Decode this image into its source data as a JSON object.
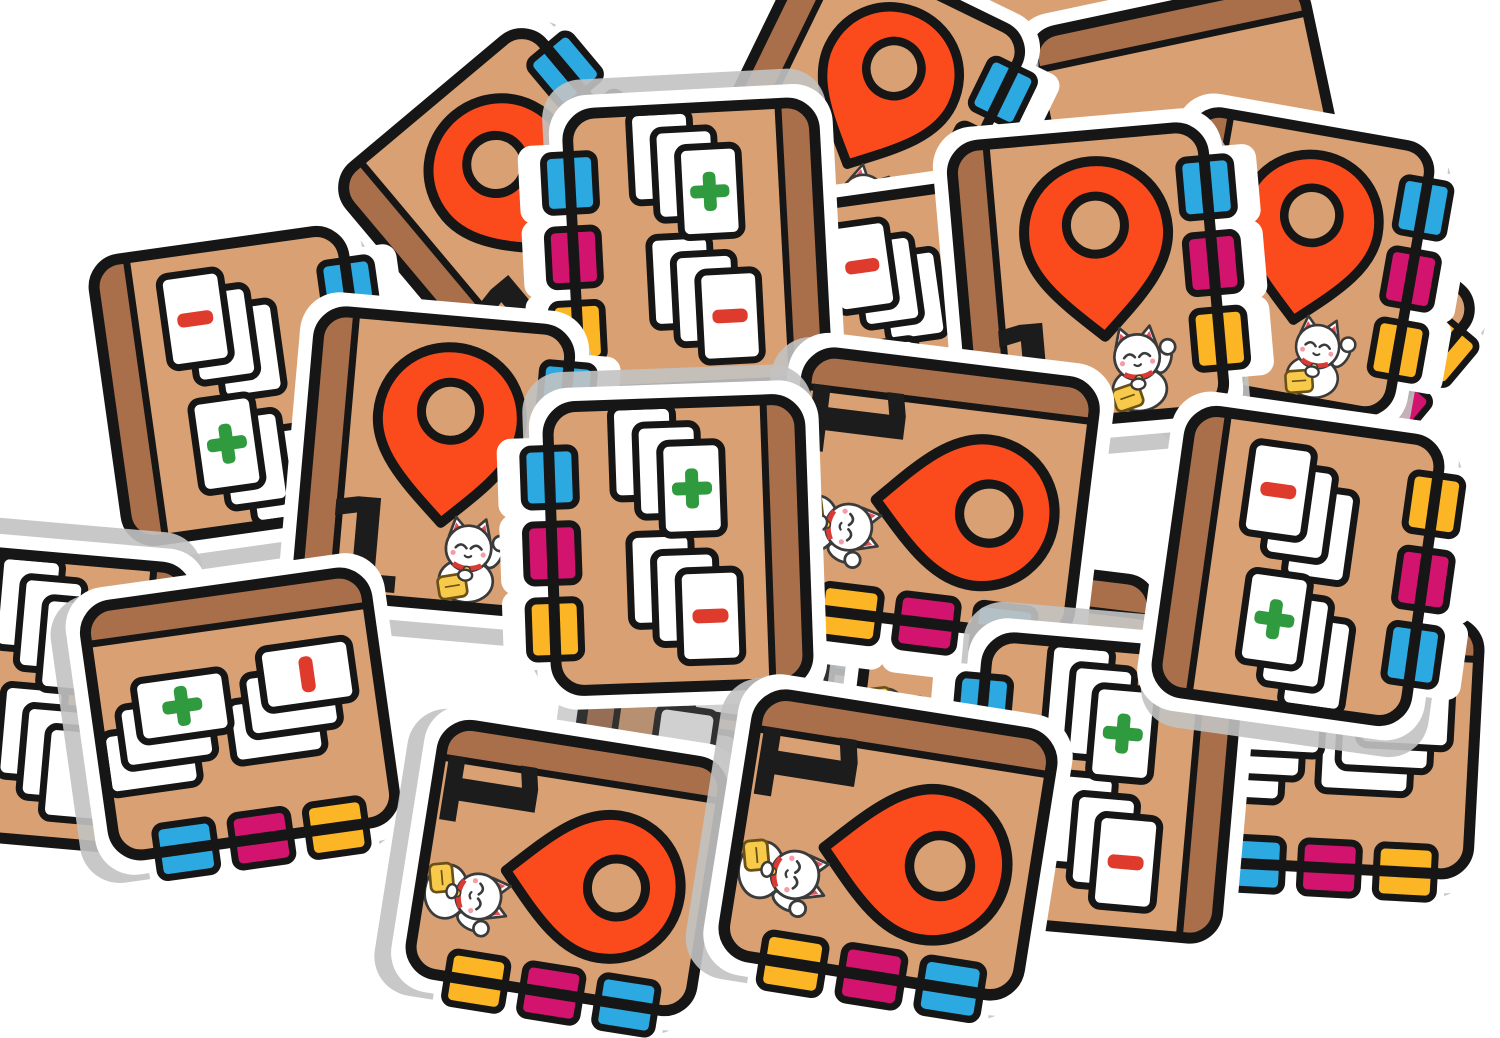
{
  "scene": {
    "label": "pile of cardboard notebook game tiles",
    "width": 1500,
    "height": 1038,
    "background": "#ffffff"
  },
  "palette": {
    "sticker": "#ffffff",
    "shadow": "#c2c2c2",
    "outline": "#161616",
    "cover": "#d9a173",
    "spine": "#a86f4a",
    "pin": "#fb4b1c",
    "pin_hole": "#d9a173",
    "card": "#ffffff",
    "number": "#1c1c1c",
    "plus": "#2f9b3e",
    "minus": "#df3b2d",
    "tabs": {
      "blue": "#2ba9e0",
      "magenta": "#d2146e",
      "yellow": "#fcb525"
    },
    "cat": {
      "body": "#ffffff",
      "outline": "#3b3b3b",
      "inner_ear": "#e8505b",
      "cheek": "#f59da6",
      "collar": "#d93a34",
      "coin": "#f8ca4b",
      "coin_outline": "#6b5116"
    }
  },
  "tile_types": {
    "pin": {
      "label": "location marker notebook tile",
      "number": "1"
    },
    "cards": {
      "label": "card stacks notebook tile",
      "plus_glyph": "+",
      "minus_glyph": "−"
    },
    "cover": {
      "label": "plain notebook tile"
    }
  },
  "tiles": [
    {
      "id": "cover-back-top-right",
      "type": "cover",
      "cx": 985,
      "cy": 92,
      "rot": 18,
      "scale": 0.95,
      "tabs": [
        "blue",
        "magenta",
        "yellow"
      ]
    },
    {
      "id": "cover-side-top-right",
      "type": "cover",
      "cx": 1190,
      "cy": 128,
      "rot": 78,
      "scale": 0.98,
      "tabs": [
        "blue",
        "magenta",
        "yellow"
      ]
    },
    {
      "id": "pin-tile-top-mid-right",
      "type": "pin",
      "cx": 862,
      "cy": 108,
      "rot": 26,
      "scale": 0.95,
      "tabs": [
        "blue",
        "magenta",
        "yellow"
      ]
    },
    {
      "id": "cover-back-far-right",
      "type": "cover",
      "cx": 1302,
      "cy": 332,
      "rot": 40,
      "scale": 0.95,
      "tabs": [
        "yellow",
        "magenta",
        "blue"
      ]
    },
    {
      "id": "pin-tile-far-right",
      "type": "pin",
      "cx": 1292,
      "cy": 262,
      "rot": 10,
      "scale": 0.95,
      "tabs": [
        "blue",
        "magenta",
        "yellow"
      ]
    },
    {
      "id": "cards-tile-behind-right",
      "type": "cards",
      "cx": 900,
      "cy": 330,
      "rot": -8,
      "scale": 0.95,
      "tabs": [
        "blue",
        "magenta",
        "yellow"
      ],
      "symbols": [
        "minus",
        "plus"
      ]
    },
    {
      "id": "pin-tile-top-right",
      "type": "pin",
      "cx": 1088,
      "cy": 278,
      "rot": -5,
      "scale": 1,
      "tabs": [
        "blue",
        "magenta",
        "yellow"
      ]
    },
    {
      "id": "pin-tile-top-left",
      "type": "pin",
      "cx": 520,
      "cy": 212,
      "rot": -40,
      "scale": 1,
      "tabs": [
        "blue",
        "magenta",
        "yellow"
      ]
    },
    {
      "id": "cards-tile-top-center",
      "type": "cards",
      "cx": 697,
      "cy": 247,
      "rot": 177,
      "scale": 0.98,
      "tabs": [
        "yellow",
        "magenta",
        "blue"
      ],
      "symbols": [
        "minus",
        "plus"
      ]
    },
    {
      "id": "cards-tile-left",
      "type": "cards",
      "cx": 235,
      "cy": 386,
      "rot": -8,
      "scale": 1,
      "tabs": [
        "blue",
        "magenta",
        "yellow"
      ],
      "symbols": [
        "minus",
        "plus"
      ]
    },
    {
      "id": "cards-tile-far-left-edge",
      "type": "cards",
      "cx": 52,
      "cy": 700,
      "rot": 185,
      "scale": 1,
      "tabs": [
        "yellow",
        "magenta",
        "blue"
      ],
      "symbols": [
        "none",
        "none"
      ]
    },
    {
      "id": "cards-tile-shaded-center",
      "type": "cards",
      "cx": 705,
      "cy": 702,
      "rot": 8,
      "scale": 0.95,
      "tabs": [
        "blue",
        "magenta",
        "yellow"
      ],
      "symbols": [
        "none",
        "none"
      ],
      "dim": true
    },
    {
      "id": "pin-tile-hidden-center-right",
      "type": "pin",
      "cx": 1002,
      "cy": 688,
      "rot": 97,
      "scale": 0.98,
      "tabs": [
        "blue",
        "magenta",
        "yellow"
      ]
    },
    {
      "id": "pin-tile-center",
      "type": "pin",
      "cx": 938,
      "cy": 495,
      "rot": 97,
      "scale": 1.02,
      "tabs": [
        "blue",
        "magenta",
        "yellow"
      ]
    },
    {
      "id": "cards-tile-bottom-right-back",
      "type": "cards",
      "cx": 1332,
      "cy": 742,
      "rot": 93,
      "scale": 1,
      "tabs": [
        "yellow",
        "magenta",
        "blue"
      ],
      "symbols": [
        "none",
        "none"
      ]
    },
    {
      "id": "cards-tile-bottom-right-mid",
      "type": "cards",
      "cx": 1102,
      "cy": 788,
      "rot": 185,
      "scale": 1,
      "tabs": [
        "yellow",
        "magenta",
        "blue"
      ],
      "symbols": [
        "minus",
        "plus"
      ]
    },
    {
      "id": "cards-tile-right",
      "type": "cards",
      "cx": 1298,
      "cy": 566,
      "rot": 8,
      "scale": 1,
      "tabs": [
        "yellow",
        "magenta",
        "blue"
      ],
      "symbols": [
        "minus",
        "plus"
      ]
    },
    {
      "id": "pin-tile-mid-left",
      "type": "pin",
      "cx": 434,
      "cy": 462,
      "rot": 5,
      "scale": 1,
      "tabs": [
        "blue",
        "magenta",
        "yellow"
      ]
    },
    {
      "id": "cards-tile-center",
      "type": "cards",
      "cx": 678,
      "cy": 545,
      "rot": 178,
      "scale": 1,
      "tabs": [
        "yellow",
        "magenta",
        "blue"
      ],
      "symbols": [
        "minus",
        "plus"
      ]
    },
    {
      "id": "cards-tile-bottom-left",
      "type": "cards",
      "cx": 240,
      "cy": 714,
      "rot": 82,
      "scale": 1,
      "tabs": [
        "yellow",
        "magenta",
        "blue"
      ],
      "symbols": [
        "minus",
        "plus"
      ]
    },
    {
      "id": "pin-tile-bottom-left",
      "type": "pin",
      "cx": 567,
      "cy": 868,
      "rot": 99,
      "scale": 1,
      "tabs": [
        "blue",
        "magenta",
        "yellow"
      ]
    },
    {
      "id": "pin-tile-bottom-center",
      "type": "pin",
      "cx": 888,
      "cy": 845,
      "rot": 99,
      "scale": 1.05,
      "tabs": [
        "blue",
        "magenta",
        "yellow"
      ]
    }
  ]
}
